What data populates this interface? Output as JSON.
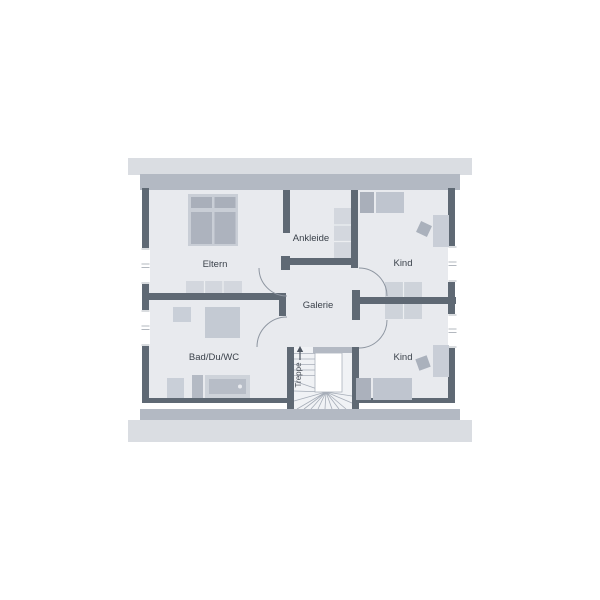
{
  "plan": {
    "type": "floor-plan",
    "floor": "upper-floor",
    "rooms": {
      "eltern": {
        "label": "Eltern"
      },
      "ankleide": {
        "label": "Ankleide"
      },
      "kind_top": {
        "label": "Kind"
      },
      "galerie": {
        "label": "Galerie"
      },
      "bad": {
        "label": "Bad/Du/WC"
      },
      "kind_bottom": {
        "label": "Kind"
      },
      "treppe": {
        "label": "Treppe"
      }
    },
    "stairs": {
      "direction": "up",
      "arrow": "up-arrow"
    },
    "windows": [
      "left-wall-window-eltern",
      "left-wall-window-bad",
      "right-wall-window-kind-top",
      "right-wall-window-kind-bottom"
    ],
    "doors": [
      "door-eltern",
      "door-bad",
      "door-kind-top",
      "door-kind-bottom"
    ],
    "furniture": [
      {
        "room": "eltern",
        "items": [
          "double-bed",
          "dresser"
        ]
      },
      {
        "room": "ankleide",
        "items": [
          "wardrobe"
        ]
      },
      {
        "room": "kind_top",
        "items": [
          "bed",
          "desk",
          "chair",
          "wardrobe"
        ]
      },
      {
        "room": "kind_bottom",
        "items": [
          "bed",
          "desk",
          "chair",
          "wardrobe"
        ]
      },
      {
        "room": "bad",
        "items": [
          "wc",
          "shower",
          "washbasin",
          "cabinet",
          "bathtub"
        ]
      }
    ],
    "palette": {
      "background": "#ffffff",
      "roof_band": "#dadde2",
      "exterior_wall": "#b3b9c3",
      "interior_wall": "#5f6974",
      "floor": "#e8eaee",
      "stair_floor": "#f0f2f5",
      "furniture_light": "#d3d7de",
      "furniture_mid": "#bfc5cf",
      "furniture_dark": "#a9afba",
      "line": "#9aa1ab",
      "text": "#3b424b"
    }
  }
}
